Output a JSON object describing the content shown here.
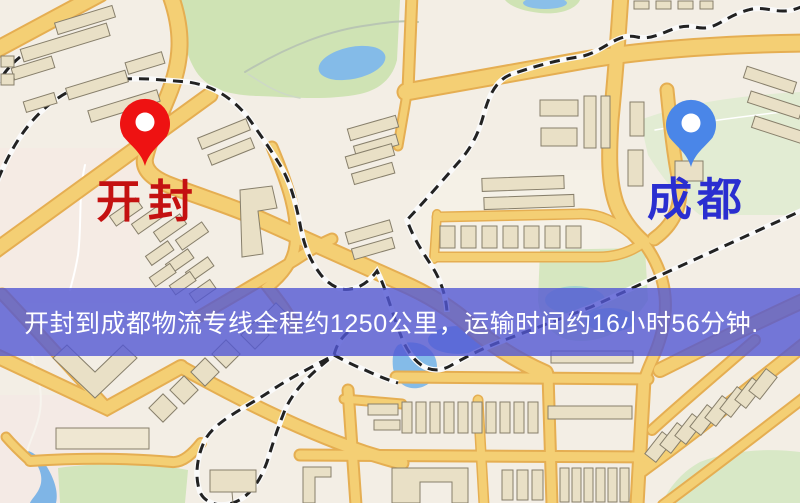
{
  "banner": {
    "text": "开封到成都物流专线全程约1250公里，运输时间约16小时56分钟.",
    "background": "#5358d3",
    "text_color": "#ffffff"
  },
  "markers": {
    "origin": {
      "label": "开封",
      "pin_color": "#ee1212",
      "label_color": "#c41111"
    },
    "destination": {
      "label": "成都",
      "pin_color": "#4a86e8",
      "label_color": "#2a2ed0"
    }
  },
  "map": {
    "colors": {
      "background": "#f3eee5",
      "road_fill": "#f4cf74",
      "road_casing": "#e5ae52",
      "building_fill": "#e9e0c6",
      "building_outline": "#877f6b",
      "park_green": "#cfe3b4",
      "pale_green": "#e2ecd3",
      "water_blue": "#84bbe8",
      "railway_dash": "#222222"
    }
  }
}
